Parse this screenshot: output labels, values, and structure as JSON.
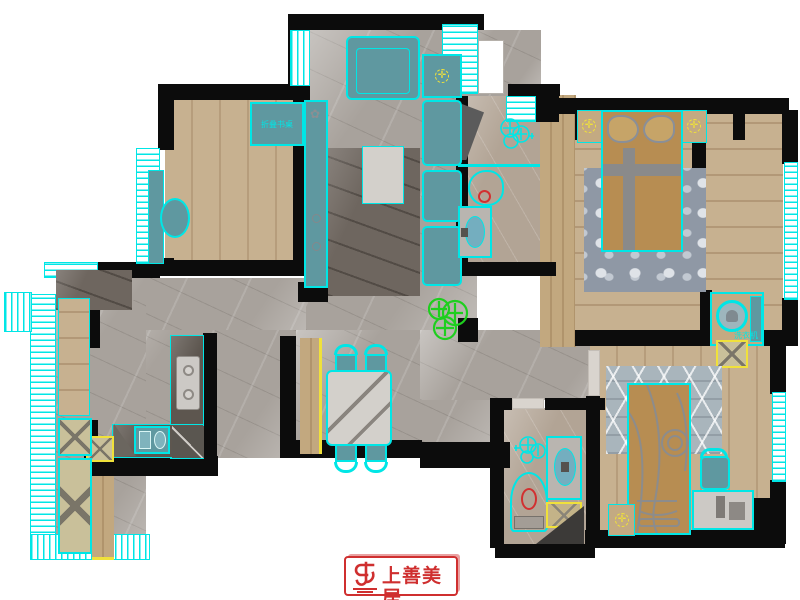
{
  "title": "apartment floor plan",
  "colors": {
    "cyan": "#00e6e6",
    "teal": "#5f98a0",
    "yellow": "#f0e13a",
    "red": "#cf2f2f",
    "green": "#1ecf1e",
    "wall": "#0c0c0c",
    "bed_tan": "#b78d52",
    "marble": "#a8a29c",
    "beige": "#b2a495",
    "wood": "#c7b190"
  },
  "labels": {
    "folding_desk": "折叠书桌",
    "washing_machine": "洗衣机"
  },
  "logo": {
    "text": "上善美居"
  }
}
